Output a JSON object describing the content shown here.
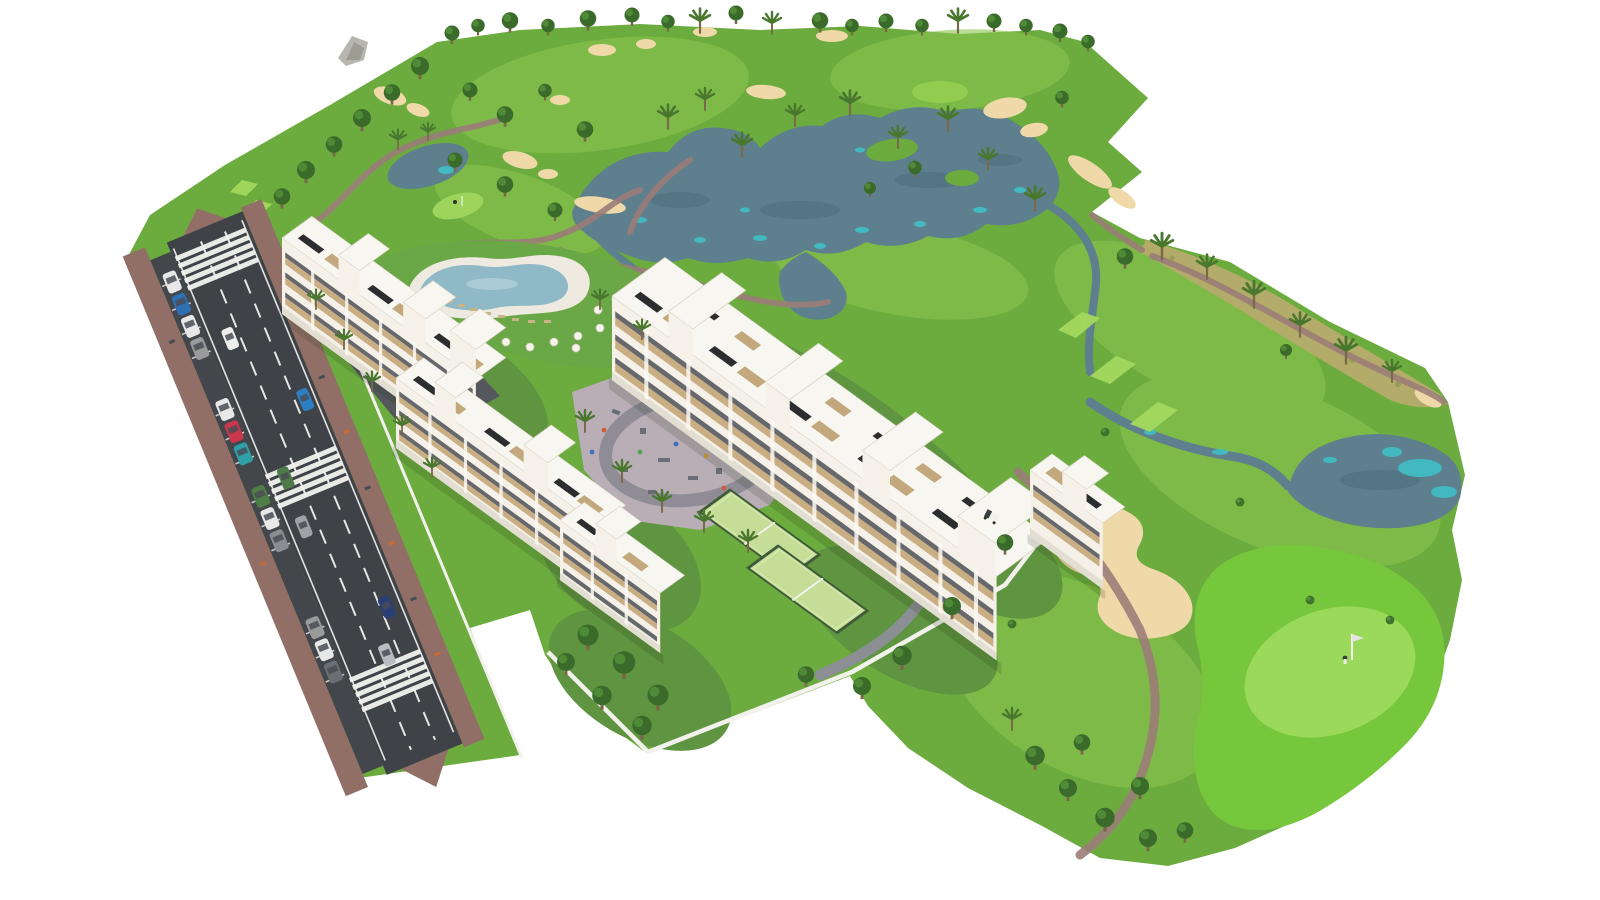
{
  "scene": {
    "type": "aerial-3d-architectural-render",
    "subject": "golf-resort-masterplan"
  },
  "palette": {
    "background": "#ffffff",
    "rough_green": "#6cac3f",
    "fairway_green": "#8ac44d",
    "bright_green": "#76c73c",
    "putting_green": "#9ad95a",
    "tee_green": "#a4d95e",
    "garden_green": "#5f9440",
    "lawn_green": "#6aa746",
    "tree_dark": "#3a6b2a",
    "palm_green": "#4a772e",
    "scrub_tan": "#b3ab69",
    "sand": "#f0d9a8",
    "lake_slate": "#5e7f8d",
    "lake_teal": "#3ec3c9",
    "path_mauve": "#9b7d78",
    "road_asphalt": "#3f4247",
    "parking_asphalt": "#43464b",
    "road_markings": "#f4f4f2",
    "sidewalk_brick": "#916f67",
    "building_white": "#f5f1e8",
    "band_beige": "#c9ad83",
    "glass_dark": "#42464b",
    "pergola_dark": "#2b2d2f",
    "pool_water": "#8fb9c6",
    "pool_deck": "#eeeae0",
    "padel_green": "#c5dd97",
    "padel_fence": "#3f5a38",
    "playground_paving": "#b9aeb6",
    "playground_path": "#8f8c96",
    "wall_white": "#f2f1ec",
    "drive_asphalt": "#54575c",
    "cart_white": "#f2f1ec"
  },
  "features": {
    "residential_blocks": 4,
    "end_tower_blocks": 1,
    "swimming_pools": 1,
    "playgrounds": 1,
    "padel_courts": 2,
    "crosswalks": 3,
    "parked_cars": 13,
    "moving_cars": 6,
    "golf_flags": 2,
    "lakes": 3,
    "golf_carts": 1
  }
}
